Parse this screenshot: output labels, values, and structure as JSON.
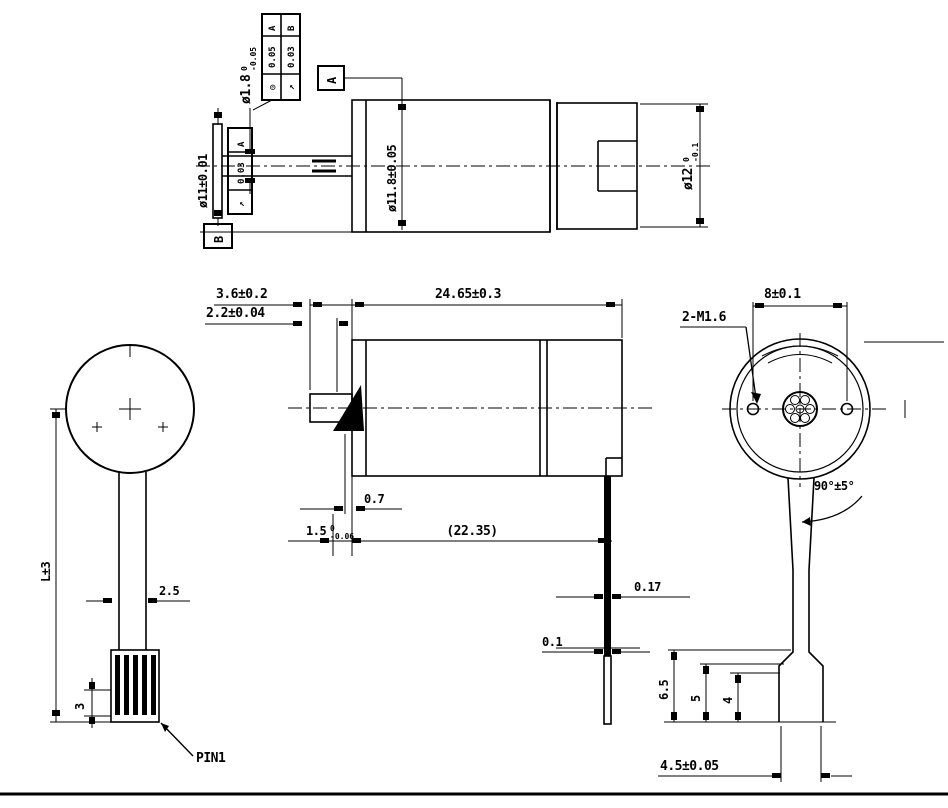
{
  "page": {
    "background": "#ffffff",
    "ink": "#000000"
  },
  "labels": {
    "top": {
      "shaft_dia": {
        "value": "ø1.8",
        "tol_upper": "0",
        "tol_lower": "-0.05"
      },
      "fcf_col1": {
        "symbol": "◎",
        "value": "0.05",
        "datum": "A"
      },
      "fcf_col2": {
        "symbol": "↗",
        "value": "0.03",
        "datum": "B"
      },
      "datum_a": "A",
      "datum_b": "B",
      "left_dia": "ø11±0.01",
      "left_fcf": {
        "symbol": "↗",
        "value": "0.03",
        "datum": "A"
      },
      "body_dia": "ø11.8±0.05",
      "right_dia": {
        "value": "ø12",
        "tol_upper": "0",
        "tol_lower": "-0.1"
      }
    },
    "side": {
      "protrusion": "3.6±0.2",
      "dcut": "2.2±0.04",
      "overall": "24.65±0.3",
      "step": "0.7",
      "boss": {
        "value": "1.5",
        "tol_upper": "0",
        "tol_lower": "-0.06"
      },
      "body_ref": "(22.35)",
      "tab_thickness": "0.17",
      "tab_offset": "0.1"
    },
    "front": {
      "length": "L±3",
      "ribbon_width": "2.5",
      "pin_length": "3",
      "pin_label": "PIN1"
    },
    "rear": {
      "hole_spacing": "8±0.1",
      "screw_callout": "2-M1.6",
      "exit_angle": "90°±5°",
      "step1": "6.5",
      "step2": "5",
      "step3": "4",
      "connector_width": "4.5±0.05"
    }
  }
}
